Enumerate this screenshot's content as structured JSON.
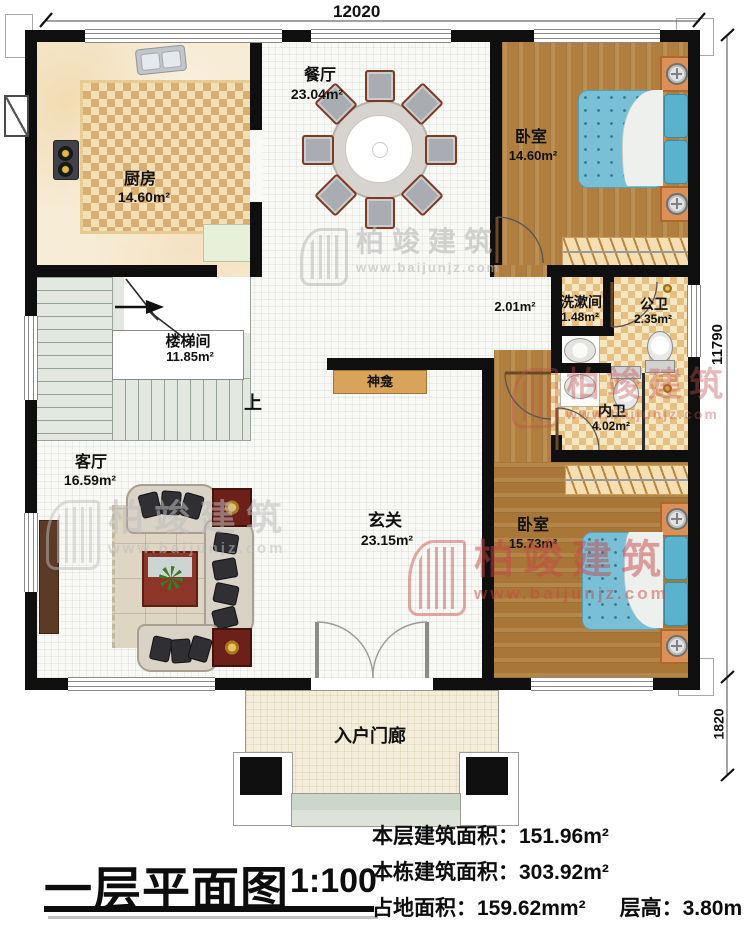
{
  "dimensions": {
    "top": "12020",
    "right_upper": "11790",
    "right_lower": "1820"
  },
  "rooms": {
    "dining": {
      "name": "餐厅",
      "area": "23.04m²"
    },
    "kitchen": {
      "name": "厨房",
      "area": "14.60m²"
    },
    "bedroom_top": {
      "name": "卧室",
      "area": "14.60m²"
    },
    "stairwell": {
      "name": "楼梯间",
      "area": "11.85m²"
    },
    "corridor": {
      "area": "2.01m²"
    },
    "washroom": {
      "name": "洗漱间",
      "area": "1.48m²"
    },
    "public_bath": {
      "name": "公卫",
      "area": "2.35m²"
    },
    "private_bath": {
      "name": "内卫",
      "area": "4.02m²"
    },
    "living": {
      "name": "客厅",
      "area": "16.59m²"
    },
    "foyer": {
      "name": "玄关",
      "area": "23.15m²"
    },
    "bedroom_bottom": {
      "name": "卧室",
      "area": "15.73m²"
    },
    "shrine": {
      "name": "神龛"
    },
    "porch": {
      "name": "入户门廊"
    },
    "stairs_up": "上"
  },
  "title_block": {
    "title": "一层平面图",
    "scale": "1:100"
  },
  "stats": {
    "line1_label": "本层建筑面积：",
    "line1_value": "151.96m²",
    "line2_label": "本栋建筑面积：",
    "line2_value": "303.92m²",
    "line3_label": "占地面积：",
    "line3_value": "159.62mm²",
    "line4_label": "层高：",
    "line4_value": "3.80m"
  },
  "watermark": {
    "brand": "柏竣建筑",
    "url": "www.baijunjz.com"
  }
}
